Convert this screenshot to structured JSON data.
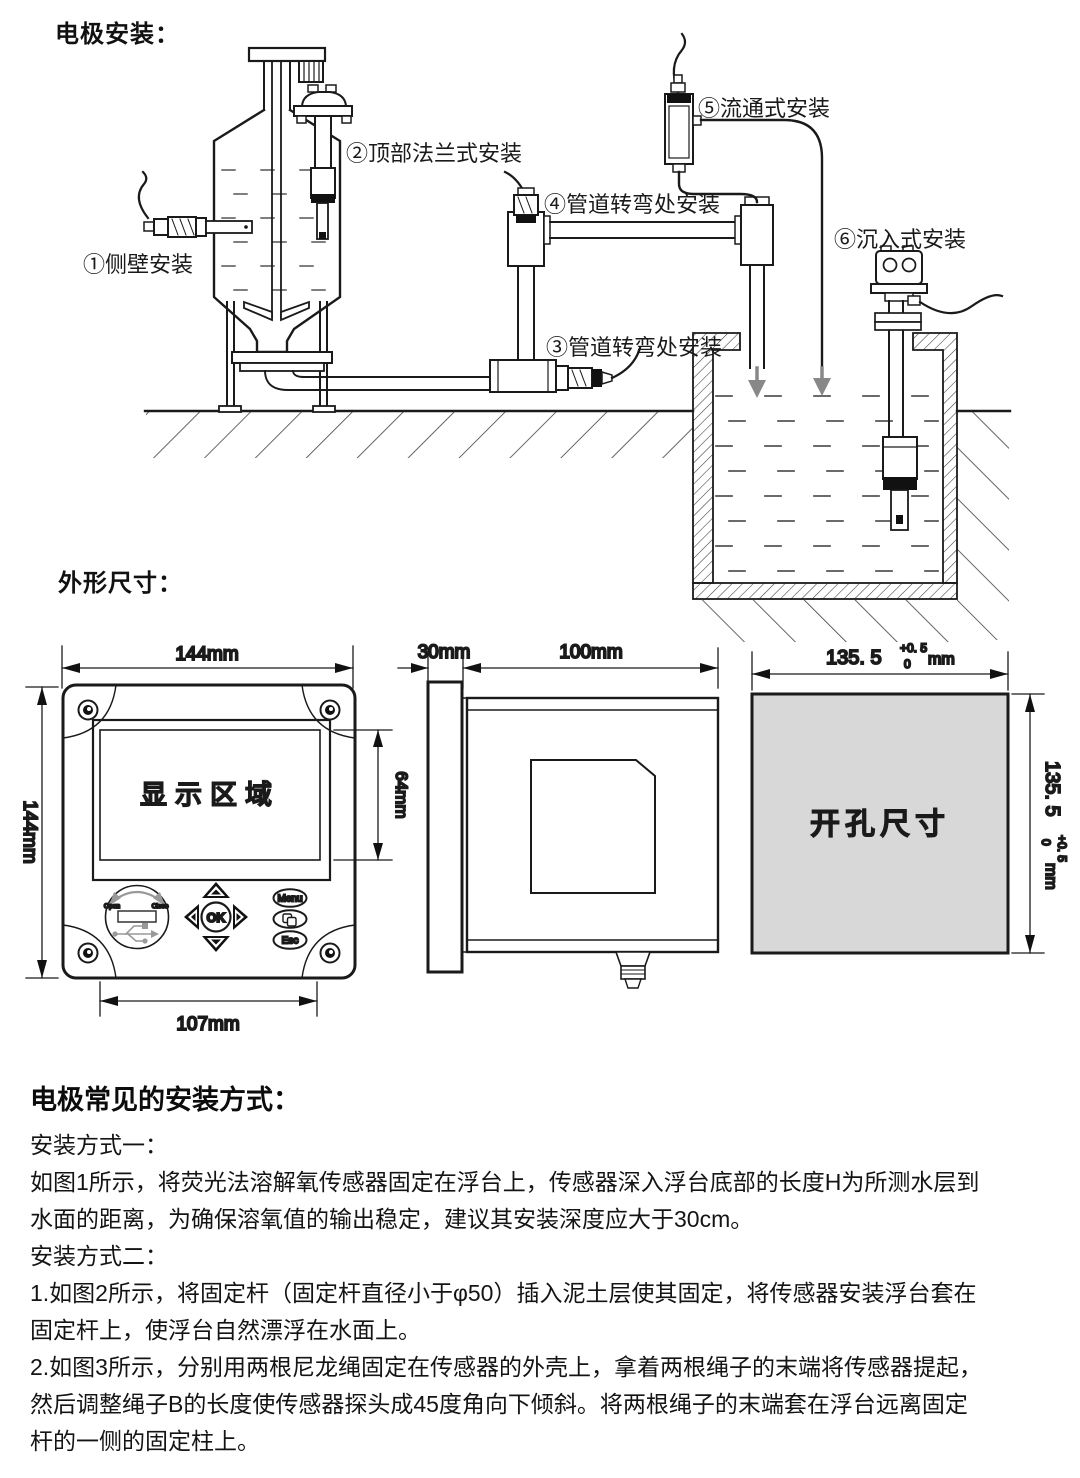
{
  "titles": {
    "electrode_install": "电极安装：",
    "dimensions": "外形尺寸："
  },
  "install_diagram": {
    "labels": [
      {
        "text": "①侧壁安装"
      },
      {
        "text": "②顶部法兰式安装"
      },
      {
        "text": "③管道转弯处安装"
      },
      {
        "text": "④管道转弯处安装"
      },
      {
        "text": "⑤流通式安装"
      },
      {
        "text": "⑥沉入式安装"
      }
    ]
  },
  "front_view": {
    "width_label": "144mm",
    "height_label": "144mm",
    "screen_height_label": "64mm",
    "bottom_width_label": "107mm",
    "display_area": "显示区域",
    "usb_open": "Open",
    "usb_close": "Close",
    "ok_button": "OK",
    "menu_button": "Menu",
    "esc_button": "Esc"
  },
  "side_view": {
    "depth_label": "30mm",
    "body_label": "100mm"
  },
  "cutout_view": {
    "label": "开孔尺寸",
    "dim_value": "135. 5",
    "tol_upper": "+0. 5",
    "tol_lower": "0",
    "unit": "mm"
  },
  "install_methods": {
    "heading": "电极常见的安装方式：",
    "lines": [
      "安装方式一：",
      "如图1所示，将荧光法溶解氧传感器固定在浮台上，传感器深入浮台底部的长度H为所测水层到",
      "水面的距离，为确保溶氧值的输出稳定，建议其安装深度应大于30cm。",
      "安装方式二：",
      "1.如图2所示，将固定杆（固定杆直径小于φ50）插入泥土层使其固定，将传感器安装浮台套在",
      "固定杆上，使浮台自然漂浮在水面上。",
      "2.如图3所示，分别用两根尼龙绳固定在传感器的外壳上，拿着两根绳子的末端将传感器提起，",
      "然后调整绳子B的长度使传感器探头成45度角向下倾斜。将两根绳子的末端套在浮台远离固定",
      "杆的一侧的固定柱上。"
    ]
  }
}
